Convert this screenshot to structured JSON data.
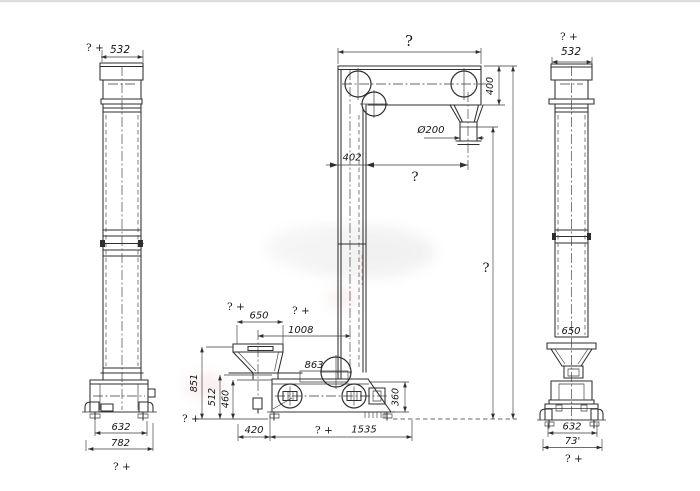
{
  "page": {
    "background": "#ffffff",
    "line_color": "#2e2e2e",
    "text_color": "#161616",
    "accent_red": "#c26a6a"
  },
  "views": {
    "left_side_view": {
      "top_width": {
        "prefix": "? +",
        "value": "532"
      },
      "base_inner_width": "632",
      "base_outer_width": "782",
      "bottom_note": "? +"
    },
    "front_view": {
      "head_width": "?",
      "head_height": "400",
      "discharge_diameter": "Ø200",
      "leg_width": "402",
      "discharge_offset": "?",
      "elevator_height": "?",
      "hopper_width": {
        "prefix": "? +",
        "value": "650"
      },
      "hopper_center_offset": {
        "prefix": "? +",
        "value": "1008"
      },
      "inlet_length": "863",
      "hopper_height": "851",
      "inlet_height": "512",
      "boot_top_height": "460",
      "ground_note": "? +",
      "boot_left_offset": "420",
      "base_length": {
        "prefix": "? +",
        "value": "1535"
      },
      "boot_end_height": "360"
    },
    "right_side_view": {
      "top_note": "? +",
      "top_width": "532",
      "boot_width": "650",
      "base_inner_width": "632",
      "base_outer_width": "73'",
      "bottom_note": "? +"
    }
  }
}
